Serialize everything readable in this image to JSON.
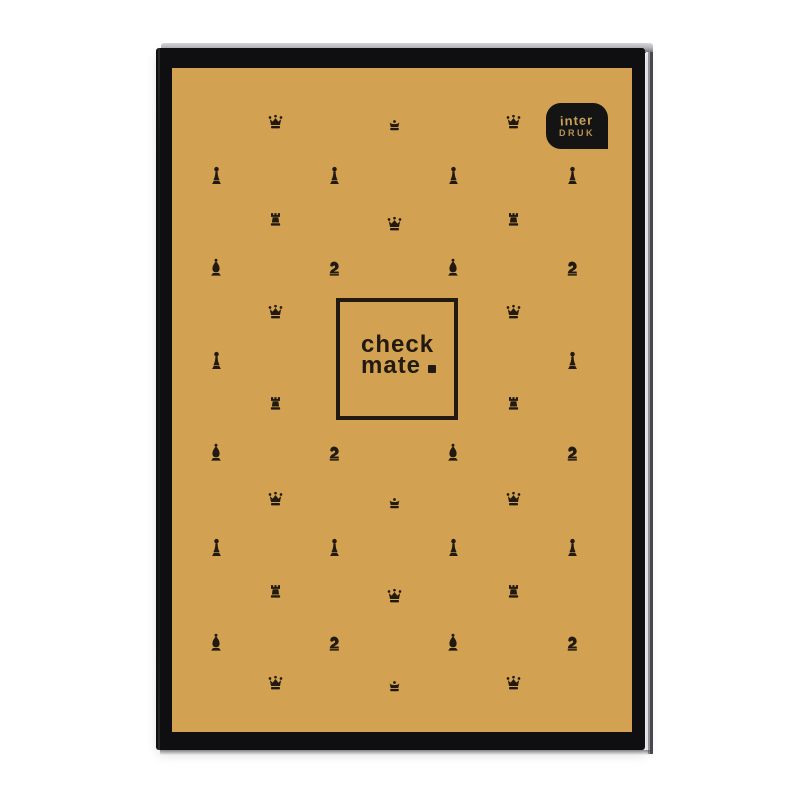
{
  "cover": {
    "title_line1": "check",
    "title_line2": "mate",
    "title_punctuation": "."
  },
  "logo": {
    "line1": "inter",
    "line2": "DRUK"
  },
  "colors": {
    "photo_bg": "#ffffff",
    "cover_gold": "#d2a252",
    "cover_black": "#0f0f11",
    "ink": "#221a10",
    "logo_bg": "#141414",
    "logo_text": "#c9a05c",
    "backcover_edge": "#4a4a50"
  },
  "pattern": {
    "pieces": [
      {
        "g": "crown",
        "x": 275,
        "y": 121
      },
      {
        "g": "king",
        "x": 394,
        "y": 125
      },
      {
        "g": "crown",
        "x": 513,
        "y": 121
      },
      {
        "g": "pawn",
        "x": 216,
        "y": 176
      },
      {
        "g": "pawn",
        "x": 334,
        "y": 176
      },
      {
        "g": "pawn",
        "x": 453,
        "y": 176
      },
      {
        "g": "pawn",
        "x": 572,
        "y": 176
      },
      {
        "g": "rook",
        "x": 275,
        "y": 219
      },
      {
        "g": "crown",
        "x": 394,
        "y": 223
      },
      {
        "g": "rook",
        "x": 513,
        "y": 219
      },
      {
        "g": "bishop",
        "x": 216,
        "y": 267
      },
      {
        "g": "knight",
        "x": 334,
        "y": 268
      },
      {
        "g": "bishop",
        "x": 453,
        "y": 267
      },
      {
        "g": "knight",
        "x": 572,
        "y": 268
      },
      {
        "g": "crown",
        "x": 275,
        "y": 311
      },
      {
        "g": "crown",
        "x": 513,
        "y": 311
      },
      {
        "g": "pawn",
        "x": 216,
        "y": 361
      },
      {
        "g": "pawn",
        "x": 572,
        "y": 361
      },
      {
        "g": "rook",
        "x": 275,
        "y": 403
      },
      {
        "g": "rook",
        "x": 513,
        "y": 403
      },
      {
        "g": "bishop",
        "x": 216,
        "y": 452
      },
      {
        "g": "knight",
        "x": 334,
        "y": 453
      },
      {
        "g": "bishop",
        "x": 453,
        "y": 452
      },
      {
        "g": "knight",
        "x": 572,
        "y": 453
      },
      {
        "g": "crown",
        "x": 275,
        "y": 498
      },
      {
        "g": "king",
        "x": 394,
        "y": 503
      },
      {
        "g": "crown",
        "x": 513,
        "y": 498
      },
      {
        "g": "pawn",
        "x": 216,
        "y": 548
      },
      {
        "g": "pawn",
        "x": 334,
        "y": 548
      },
      {
        "g": "pawn",
        "x": 453,
        "y": 548
      },
      {
        "g": "pawn",
        "x": 572,
        "y": 548
      },
      {
        "g": "rook",
        "x": 275,
        "y": 591
      },
      {
        "g": "crown",
        "x": 394,
        "y": 595
      },
      {
        "g": "rook",
        "x": 513,
        "y": 591
      },
      {
        "g": "bishop",
        "x": 216,
        "y": 642
      },
      {
        "g": "knight",
        "x": 334,
        "y": 643
      },
      {
        "g": "bishop",
        "x": 453,
        "y": 642
      },
      {
        "g": "knight",
        "x": 572,
        "y": 643
      },
      {
        "g": "crown",
        "x": 275,
        "y": 682
      },
      {
        "g": "king",
        "x": 394,
        "y": 686
      },
      {
        "g": "crown",
        "x": 513,
        "y": 682
      }
    ]
  }
}
